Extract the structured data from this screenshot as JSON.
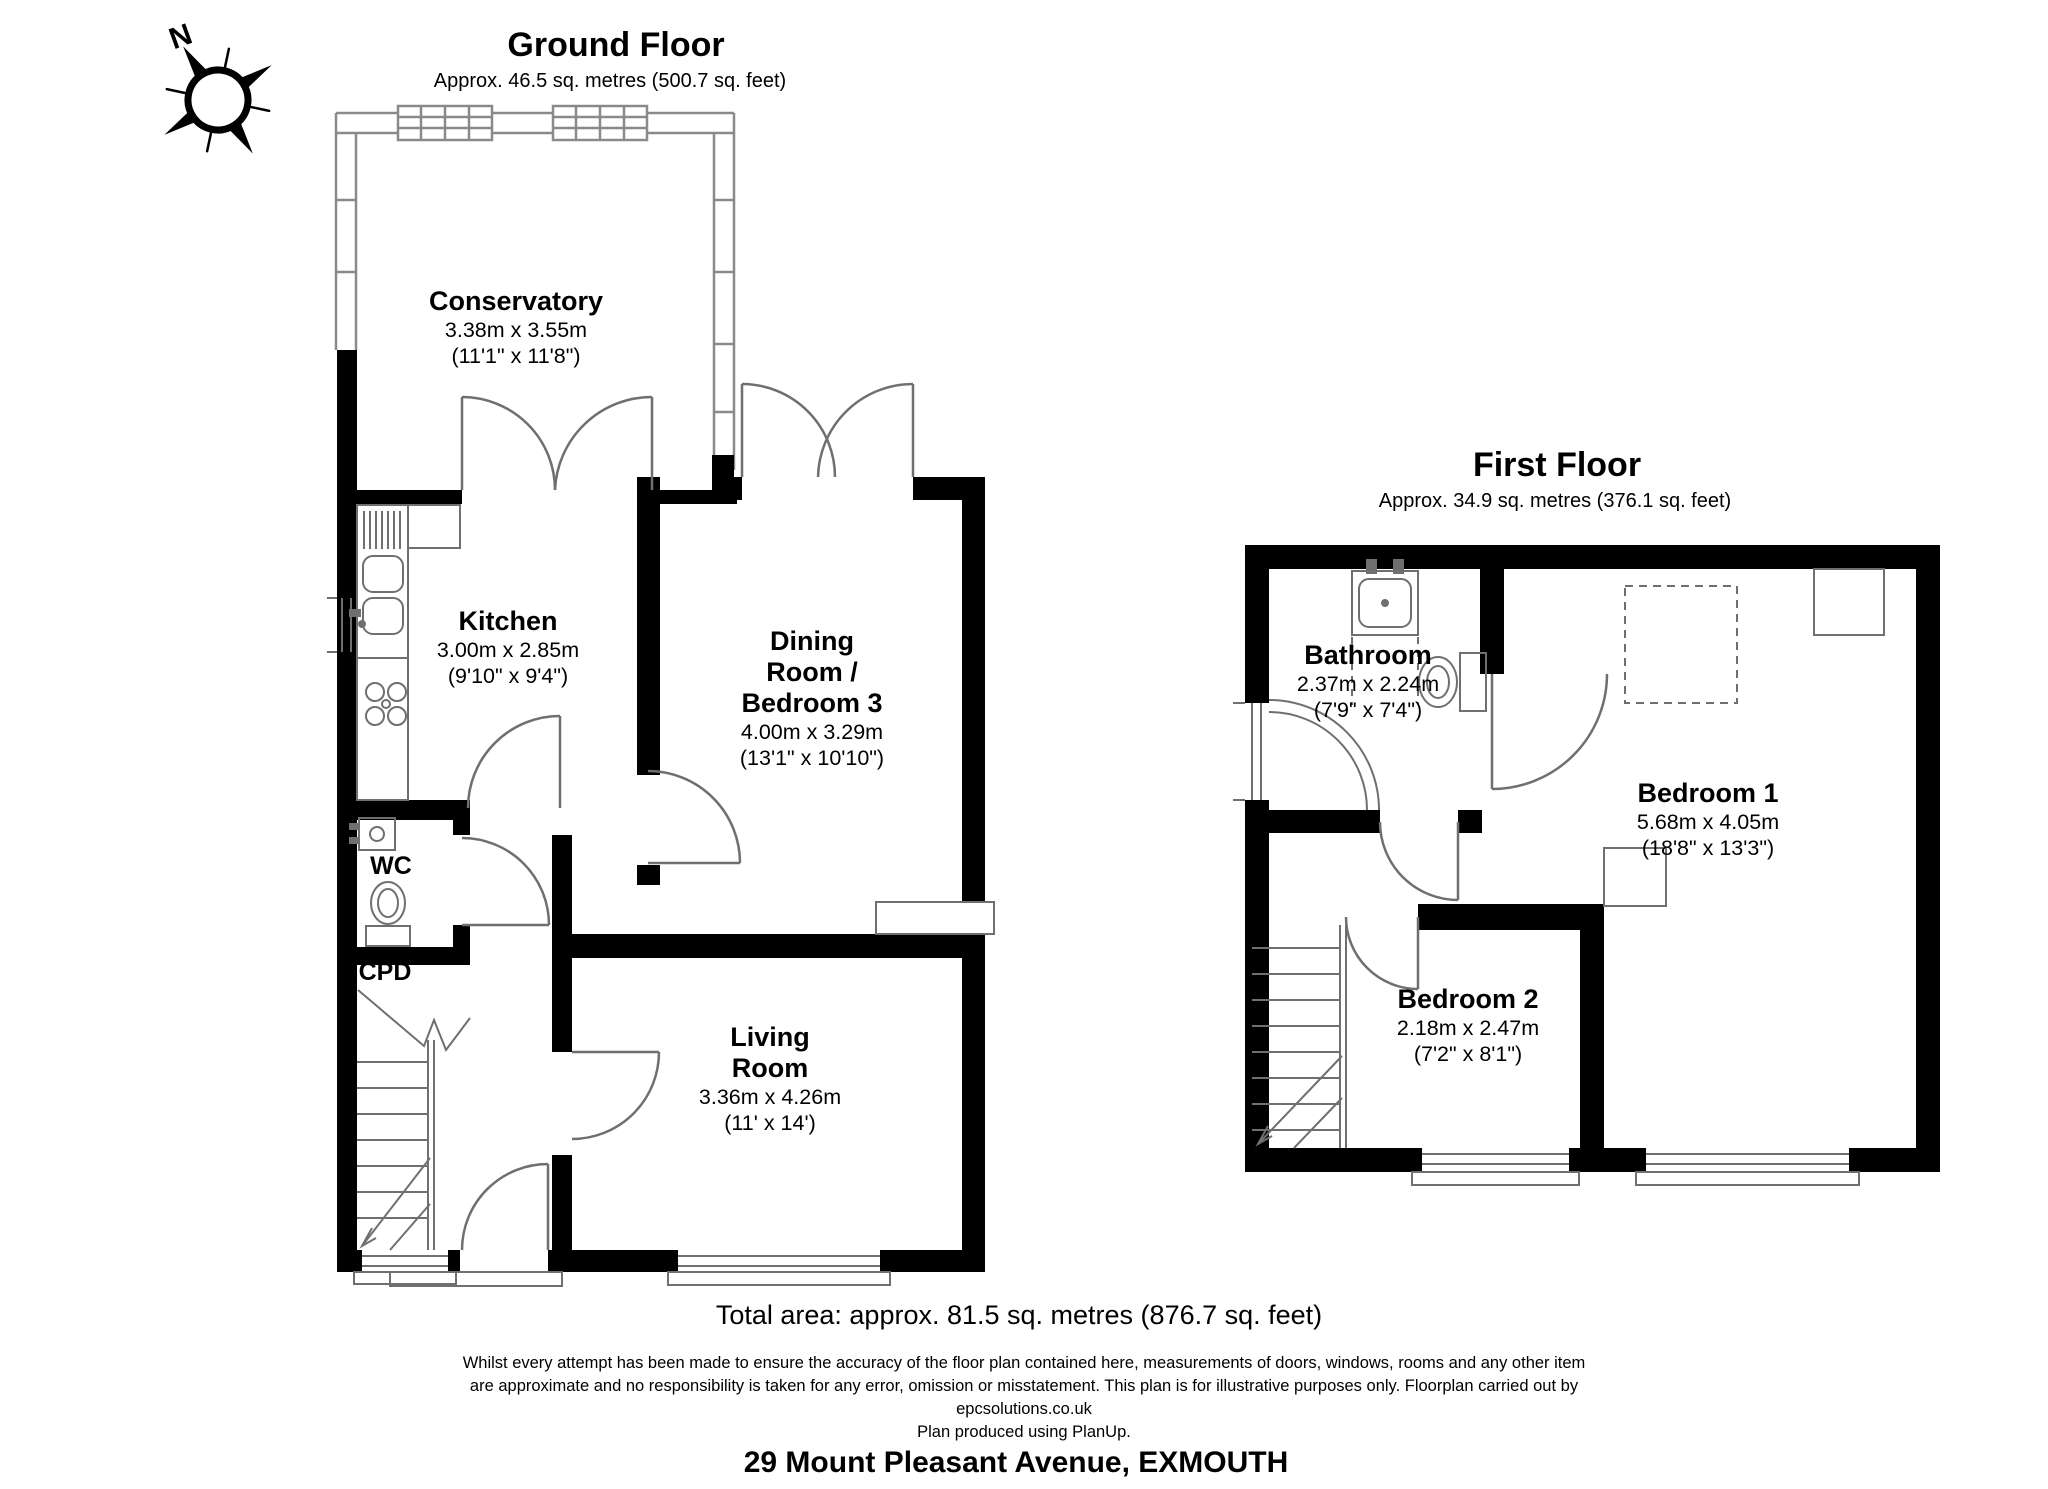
{
  "compass": {
    "north_label": "N"
  },
  "colors": {
    "wall": "#000000",
    "fixture_line": "#6f6f6f",
    "glazing_line": "#8a8a8a",
    "background": "#ffffff"
  },
  "ground_floor": {
    "title": "Ground Floor",
    "area": "Approx. 46.5 sq. metres (500.7 sq. feet)",
    "rooms": {
      "conservatory": {
        "name": "Conservatory",
        "dims_metric": "3.38m x 3.55m",
        "dims_imperial": "(11'1\" x 11'8\")"
      },
      "kitchen": {
        "name": "Kitchen",
        "dims_metric": "3.00m x 2.85m",
        "dims_imperial": "(9'10\" x 9'4\")"
      },
      "dining_room": {
        "name_lines": [
          "Dining",
          "Room /",
          "Bedroom 3"
        ],
        "dims_metric": "4.00m x 3.29m",
        "dims_imperial": "(13'1\" x 10'10\")"
      },
      "wc": {
        "name": "WC"
      },
      "cupboard": {
        "name": "CPD"
      },
      "living_room": {
        "name_lines": [
          "Living",
          "Room"
        ],
        "dims_metric": "3.36m x 4.26m",
        "dims_imperial": "(11' x 14')"
      }
    }
  },
  "first_floor": {
    "title": "First Floor",
    "area": "Approx. 34.9 sq. metres (376.1 sq. feet)",
    "rooms": {
      "bathroom": {
        "name": "Bathroom",
        "dims_metric": "2.37m x 2.24m",
        "dims_imperial": "(7'9\" x 7'4\")"
      },
      "bedroom1": {
        "name": "Bedroom 1",
        "dims_metric": "5.68m x 4.05m",
        "dims_imperial": "(18'8\" x 13'3\")"
      },
      "bedroom2": {
        "name": "Bedroom 2",
        "dims_metric": "2.18m x 2.47m",
        "dims_imperial": "(7'2\" x 8'1\")"
      }
    }
  },
  "footer": {
    "total_area": "Total area: approx. 81.5 sq. metres (876.7 sq. feet)",
    "disclaimer_lines": [
      "Whilst every attempt has been made to ensure the accuracy of the floor plan contained here, measurements of doors, windows, rooms and any other item",
      "are approximate and no responsibility is taken for any error, omission or misstatement. This plan is for illustrative purposes only. Floorplan carried out by",
      "epcsolutions.co.uk",
      "Plan produced using PlanUp."
    ],
    "address": "29 Mount Pleasant Avenue, EXMOUTH"
  }
}
